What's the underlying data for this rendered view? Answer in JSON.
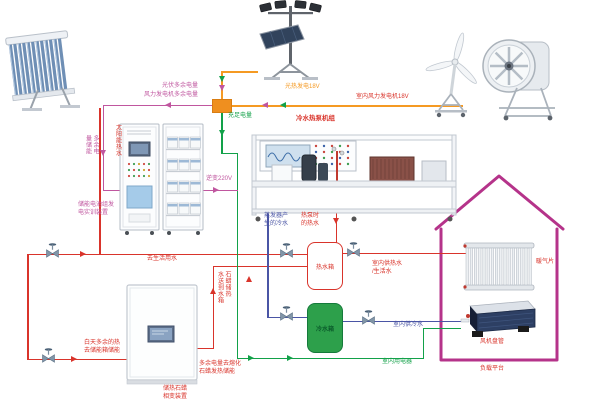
{
  "labels": {
    "pv_excess": "光伏多余电量",
    "wind_excess": "风力发电机多余电量",
    "sufficient_power": "充足电量",
    "pv_gen": "光热发电18V",
    "indoor_wind_gen": "室内风力发电机18V",
    "solar_hot_water": "太阳能热水",
    "excess_storage": "多余电\n量储能",
    "battery_device": "储能电池组发\n电实训装置",
    "inverter": "逆变220V",
    "heat_pump_title": "冷水热泵机组",
    "evaporator_cold": "蒸发器产\n生的冷水",
    "heat_pump_hot": "热泵时\n的热水",
    "hot_tank": "热水箱",
    "cold_tank": "冷水箱",
    "to_domestic_water": "去生活用水",
    "paraffin_hot_to_tank": "石蜡储热\n水送到水箱",
    "daytime_excess_heat": "白天多余的热\n去储能箱储能",
    "paraffin_device": "储热石蜡\n相变装置",
    "excess_melt_paraffin": "多余电量去熔化\n石蜡发热储能",
    "indoor_hot_supply": "室内供热水\n/生活水",
    "indoor_cold_supply": "室内供冷水",
    "indoor_appliance": "室内用电器",
    "radiator": "暖气片",
    "fan_coil": "风机盘管",
    "load_platform": "负载平台"
  },
  "colors": {
    "red": "#d9342b",
    "magenta": "#c0569f",
    "green": "#12a149",
    "orange": "#f59a23",
    "blue": "#4a55a5",
    "tank_green": "#2da04b",
    "house": "#b5338a",
    "junction": "#ef8f1f"
  }
}
